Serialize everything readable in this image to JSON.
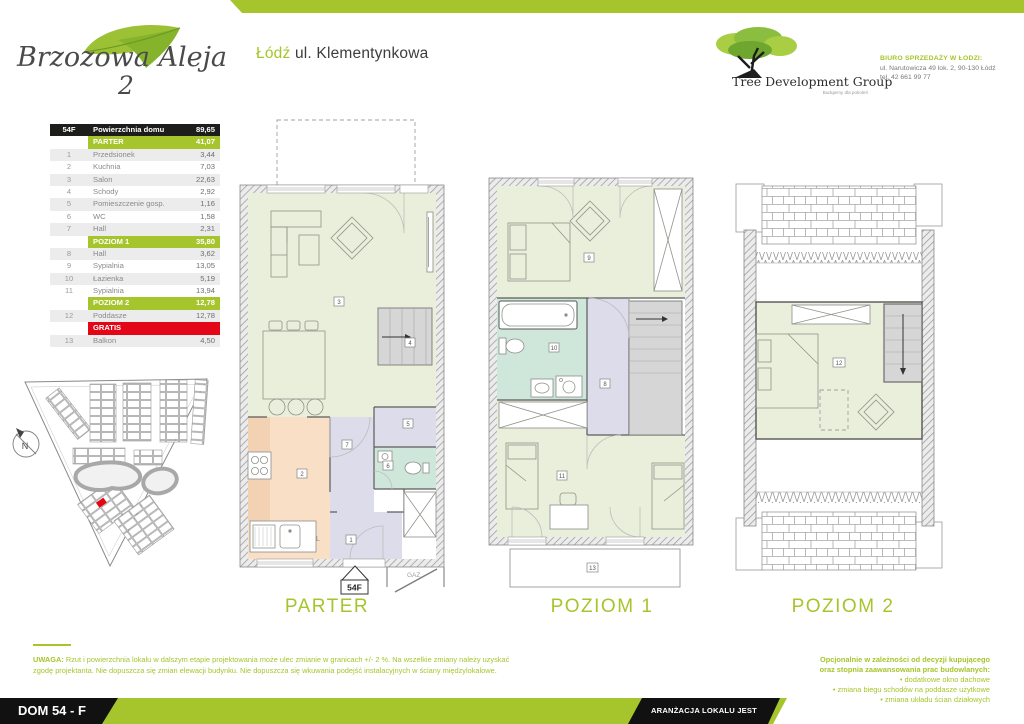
{
  "brand": {
    "name": "Brzozowa Aleja",
    "number": "2"
  },
  "location": {
    "city": "Łódź",
    "street": "ul. Klementynkowa"
  },
  "developer": {
    "name": "Tree Development Group",
    "tagline": "Budujemy dla pokoleń",
    "office_title": "BIURO SPRZEDAŻY W ŁODZI:",
    "office_address": "ul. Narutowicza 49 lok. 2, 90-130 Łódź",
    "office_phone": "tel. 42 661 99 77"
  },
  "table": {
    "rows": [
      {
        "type": "head",
        "num": "54F",
        "name": "Powierzchnia domu",
        "val": "89,65"
      },
      {
        "type": "sec",
        "num": "",
        "name": "PARTER",
        "val": "41,07"
      },
      {
        "type": "row",
        "num": "1",
        "name": "Przedsionek",
        "val": "3,44"
      },
      {
        "type": "row",
        "num": "2",
        "name": "Kuchnia",
        "val": "7,03"
      },
      {
        "type": "row",
        "num": "3",
        "name": "Salon",
        "val": "22,63"
      },
      {
        "type": "row",
        "num": "4",
        "name": "Schody",
        "val": "2,92"
      },
      {
        "type": "row",
        "num": "5",
        "name": "Pomieszczenie gosp.",
        "val": "1,16"
      },
      {
        "type": "row",
        "num": "6",
        "name": "WC",
        "val": "1,58"
      },
      {
        "type": "row",
        "num": "7",
        "name": "Hall",
        "val": "2,31"
      },
      {
        "type": "sec",
        "num": "",
        "name": "POZIOM 1",
        "val": "35,80"
      },
      {
        "type": "row",
        "num": "8",
        "name": "Hall",
        "val": "3,62"
      },
      {
        "type": "row",
        "num": "9",
        "name": "Sypialnia",
        "val": "13,05"
      },
      {
        "type": "row",
        "num": "10",
        "name": "Łazienka",
        "val": "5,19"
      },
      {
        "type": "row",
        "num": "11",
        "name": "Sypialnia",
        "val": "13,94"
      },
      {
        "type": "sec",
        "num": "",
        "name": "POZIOM 2",
        "val": "12,78"
      },
      {
        "type": "row",
        "num": "12",
        "name": "Poddasze",
        "val": "12,78"
      },
      {
        "type": "sec-red",
        "num": "",
        "name": "GRATIS",
        "val": ""
      },
      {
        "type": "row",
        "num": "13",
        "name": "Balkon",
        "val": "4,50"
      }
    ]
  },
  "plans": [
    {
      "label": "PARTER"
    },
    {
      "label": "POZIOM 1"
    },
    {
      "label": "POZIOM 2"
    }
  ],
  "room_numbers": [
    "1",
    "2",
    "3",
    "4",
    "5",
    "6",
    "7",
    "8",
    "9",
    "10",
    "11",
    "12",
    "13"
  ],
  "annotations": {
    "unit_tag": "54F",
    "gas": "GAZ",
    "kitchen_counter": "L",
    "north": "N"
  },
  "footer": {
    "note_label": "UWAGA:",
    "note": " Rzut i powierzchnia lokalu w dalszym etapie projektowania może ulec zmianie w granicach +/- 2 %. Na wszelkie zmiany należy uzyskać zgodę projektanta. Nie dopuszcza się zmian elewacji budynku. Nie dopuszcza się wkuwania podejść instalacyjnych w ściany międzylokalowe.",
    "options_intro_1": "Opcjonalnie w zależności od decyzji kupującego",
    "options_intro_2": "oraz stopnia zaawansowania prac budowlanych:",
    "options": [
      "• dodatkowe okno dachowe",
      "• zmiana biegu schodów na poddasze użytkowe",
      "• zmiana układu ścian działowych"
    ],
    "house_label": "DOM 54 - F",
    "banner": "ARANŻACJA LOKALU JEST POGLĄDOWA"
  },
  "colors": {
    "accent_green": "#a6c52d",
    "alert_red": "#e30616",
    "header_black": "#1d1d1b",
    "room_green": "#e9efda",
    "room_lavender": "#dcdceb",
    "room_peach": "#f8dfc6",
    "room_teal": "#cfe7db",
    "stairs_gray": "#d6d6d6"
  }
}
